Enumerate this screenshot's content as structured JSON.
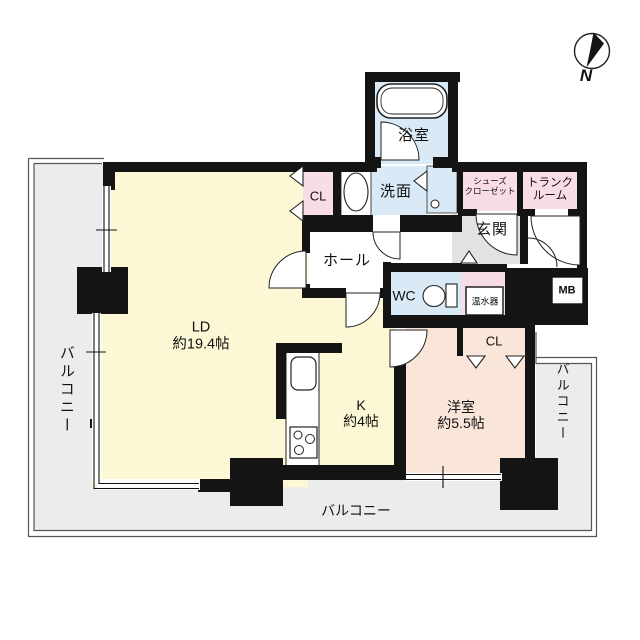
{
  "title": "1LDK apartment floor plan",
  "compass": {
    "label": "N"
  },
  "rooms": {
    "living_dining": {
      "label": "LD",
      "size": "約19.4帖"
    },
    "kitchen": {
      "label": "K",
      "size": "約4帖"
    },
    "western_room": {
      "label": "洋室",
      "size": "約5.5帖"
    },
    "bathroom": {
      "label": "浴室"
    },
    "washroom": {
      "label": "洗面"
    },
    "closet_top": {
      "label": "CL"
    },
    "shoe_closet": {
      "label_line1": "シューズ",
      "label_line2": "クローゼット"
    },
    "trunk_room": {
      "label_line1": "トランク",
      "label_line2": "ルーム"
    },
    "entrance": {
      "label": "玄関"
    },
    "hall": {
      "label": "ホール"
    },
    "toilet": {
      "label": "WC"
    },
    "water_heater": {
      "label": "温水器"
    },
    "meter_box": {
      "label": "MB"
    },
    "closet_western": {
      "label": "CL"
    }
  },
  "balconies": {
    "left": "バルコニー",
    "bottom": "バルコニー",
    "right": "バルコニー"
  },
  "colors": {
    "ld_yellow": "#fcf7d5",
    "room_pink": "#f8dde4",
    "western_peach": "#fae5d9",
    "wet_blue": "#d9e9f5",
    "balcony_gray": "#ececec",
    "genkan_gray": "#e2e2e2",
    "wall_black": "#141414"
  }
}
